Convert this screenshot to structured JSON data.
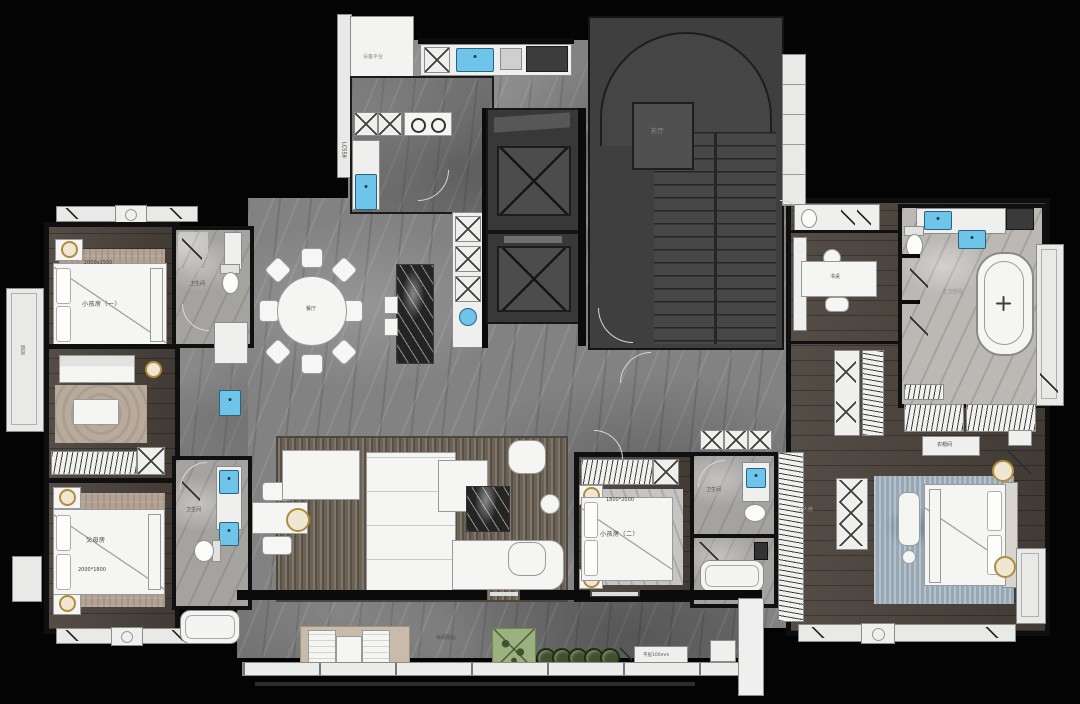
{
  "colors": {
    "background": "#040404",
    "marble_floor": "#828282",
    "wood_floor": "#4b433c",
    "bath_stone": "#a5a3a0",
    "sink_blue": "#6fc4ea",
    "gold_accent": "#b08d3e",
    "plant_green": "#9cb27e",
    "rug_master_blue": "#97a8b4",
    "rug_beige": "#b2a294",
    "furniture_white": "#f5f5f3"
  },
  "rooms": {
    "equipment_platform": {
      "label": "设备平台"
    },
    "foyer": {
      "label": "前厅"
    },
    "dining": {
      "label": "餐厅"
    },
    "kids_room_1": {
      "label": "小孩房（一）",
      "bed_size": "2000x1500"
    },
    "parents_room": {
      "label": "父母房",
      "bed_size": "2000*1800"
    },
    "kids_room_2": {
      "label": "小孩房（二）",
      "bed_size": "1800*2000"
    },
    "master_room": {
      "label": "主人房"
    },
    "study": {
      "desk_label": "书桌"
    },
    "master_bath": {
      "label": "主卫空间"
    },
    "cloakroom": {
      "label": "衣帽间"
    },
    "bathroom": {
      "label": "卫生间"
    },
    "bay_window": {
      "label": "飘窗"
    },
    "balcony": {
      "label": "休闲阳台",
      "note": "平层100mm"
    },
    "window_tag": "LC558"
  }
}
